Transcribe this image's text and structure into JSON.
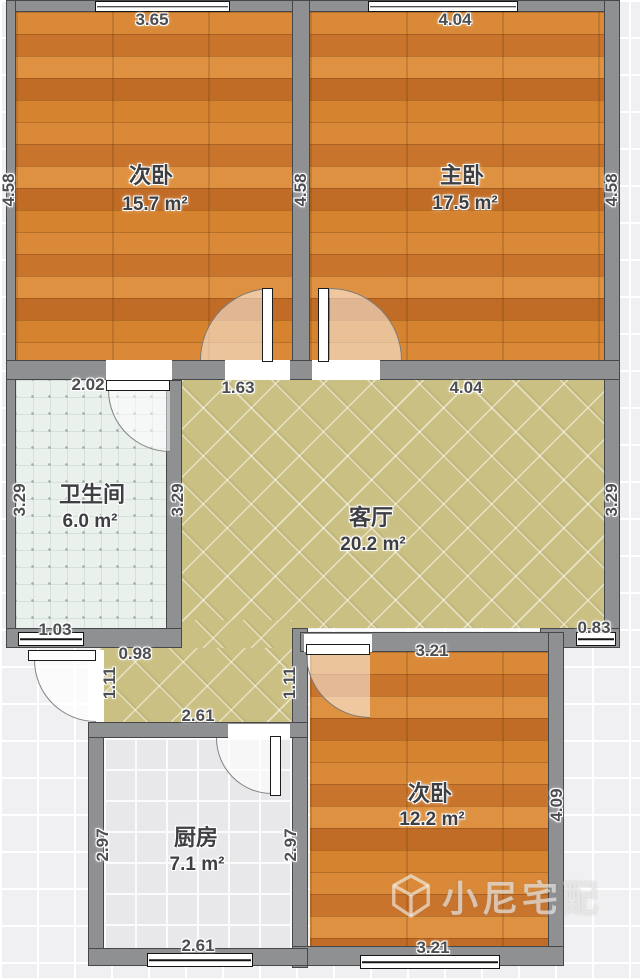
{
  "rooms": [
    {
      "id": "bedroom-top-left",
      "name": "次卧",
      "area": "15.7 m²"
    },
    {
      "id": "bedroom-top-right",
      "name": "主卧",
      "area": "17.5 m²"
    },
    {
      "id": "bathroom",
      "name": "卫生间",
      "area": "6.0 m²"
    },
    {
      "id": "living-room",
      "name": "客厅",
      "area": "20.2 m²"
    },
    {
      "id": "kitchen",
      "name": "厨房",
      "area": "7.1 m²"
    },
    {
      "id": "bedroom-bottom",
      "name": "次卧",
      "area": "12.2 m²"
    }
  ],
  "dims": {
    "bed1_top": "3.65",
    "bed2_top": "4.04",
    "left_height": "4.58",
    "mid_height": "4.58",
    "right_height": "4.58",
    "bath_top": "2.02",
    "living_top_seg": "1.63",
    "living_top": "4.04",
    "bath_left": "3.29",
    "bath_right": "3.29",
    "living_right": "3.29",
    "bath_bottom": "1.03",
    "living_bottom_right": "0.83",
    "hall_top": "0.98",
    "hall_left": "1.11",
    "hall_right": "1.11",
    "hall_bottom": "2.61",
    "kitchen_left": "2.97",
    "kitchen_right": "2.97",
    "kitchen_bottom": "2.61",
    "bed3_top": "3.21",
    "bed3_bottom": "3.21",
    "bed3_right": "4.09"
  },
  "watermark": {
    "text": "小尼宅配"
  },
  "colors": {
    "wood_floor": "#cf7b2c",
    "living_tile": "#cbc084",
    "bathroom_tile": "#eaf0ec",
    "kitchen_tile": "#e8e8ea",
    "wall": "#8f9092",
    "dimension_text": "#4d4e52",
    "background": "#f0f0f2"
  }
}
